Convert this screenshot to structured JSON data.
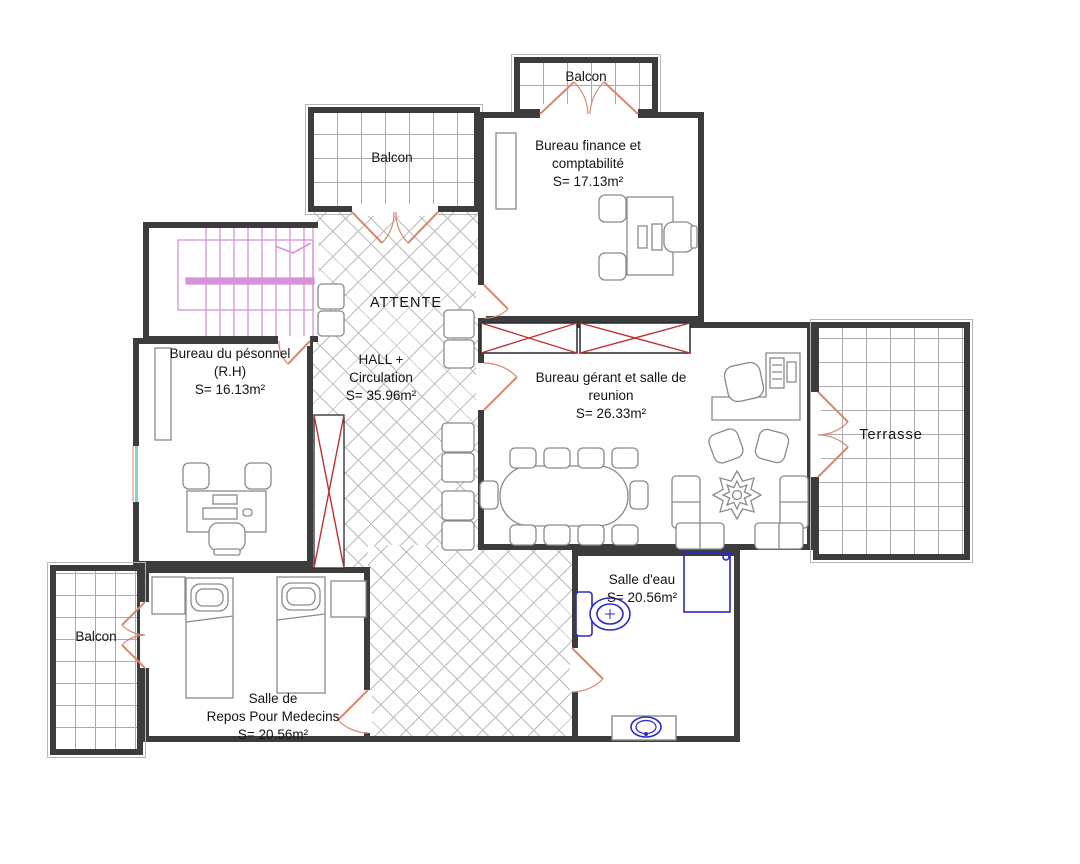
{
  "rooms": {
    "balcon_top": {
      "label": "Balcon"
    },
    "balcon_upper": {
      "label": "Balcon"
    },
    "balcon_bottom": {
      "label": "Balcon"
    },
    "attente": {
      "label": "ATTENTE"
    },
    "hall": {
      "line1": "HALL +",
      "line2": "Circulation",
      "area": "S= 35.96m²"
    },
    "finance": {
      "line1": "Bureau finance et",
      "line2": "comptabilité",
      "area": "S= 17.13m²"
    },
    "personnel": {
      "line1": "Bureau du pésonnel",
      "line2": "(R.H)",
      "area": "S= 16.13m²"
    },
    "gerant": {
      "line1": "Bureau gérant et salle de",
      "line2": "reunion",
      "area": "S= 26.33m²"
    },
    "terrasse": {
      "label": "Terrasse"
    },
    "salle_eau": {
      "line1": "Salle d'eau",
      "area": "S= 20.56m²"
    },
    "repos": {
      "line1": "Salle de",
      "line2": "Repos Pour Medecins",
      "area": "S= 20.56m²"
    }
  },
  "colors": {
    "wall": "#3c3c3c",
    "door": "#d9876f",
    "window_cross": "#c03030",
    "stairs": "#d892d8",
    "plumbing": "#2a2ac8",
    "window_glazing": "#7fd4cf",
    "tile_lines": "#ababab",
    "furniture": "#8a8a8a",
    "text": "#141414"
  }
}
